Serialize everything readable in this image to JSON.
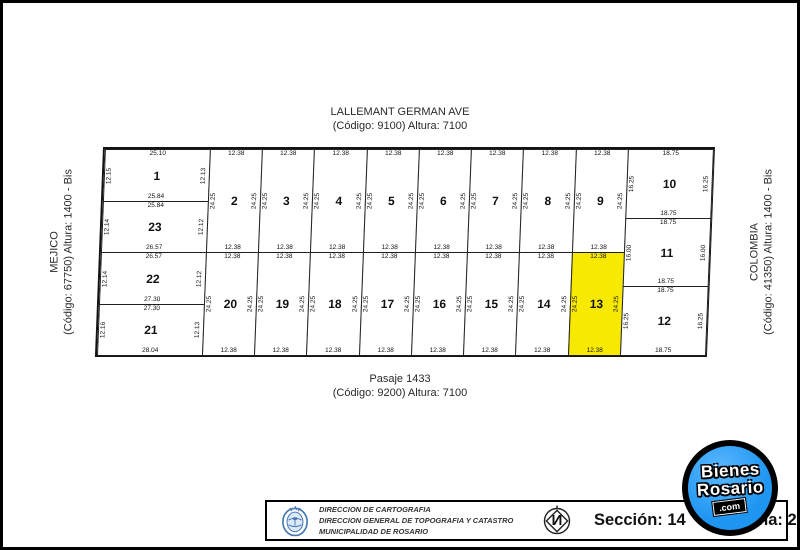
{
  "streets": {
    "top": {
      "name": "LALLEMANT GERMAN AVE",
      "detail": "(Código: 9100) Altura: 7100"
    },
    "bottom": {
      "name": "Pasaje 1433",
      "detail": "(Código: 9200) Altura: 7100"
    },
    "left": {
      "name": "MEJICO",
      "detail": "(Código: 67750) Altura: 1400 - Bis"
    },
    "right": {
      "name": "COLOMBIA",
      "detail": "(Código: 41350) Altura: 1400 - Bis"
    }
  },
  "plan": {
    "highlight_color": "#f7ea00",
    "line_color": "#1f1f1f",
    "highlighted_lot": "13",
    "lots": [
      {
        "n": "1",
        "x": 0,
        "y": 0,
        "w": 105,
        "h": 52,
        "top": "25.10",
        "bottom": "25.84",
        "left": "12.15",
        "right": "12.13",
        "hl": false
      },
      {
        "n": "23",
        "x": 0,
        "y": 52,
        "w": 105,
        "h": 51,
        "top": "25.84",
        "bottom": "26.57",
        "left": "12.14",
        "right": "12.12",
        "hl": false
      },
      {
        "n": "22",
        "x": 0,
        "y": 103,
        "w": 105,
        "h": 52,
        "top": "26.57",
        "bottom": "27.30",
        "left": "12.14",
        "right": "12.12",
        "hl": false
      },
      {
        "n": "21",
        "x": 0,
        "y": 155,
        "w": 105,
        "h": 51,
        "top": "27.30",
        "bottom": "28.04",
        "left": "12.16",
        "right": "12.13",
        "hl": false
      },
      {
        "n": "2",
        "x": 105,
        "y": 0,
        "w": 52,
        "h": 103,
        "top": "12.38",
        "bottom": "12.38",
        "left": "24.25",
        "right": "24.25",
        "hl": false
      },
      {
        "n": "3",
        "x": 157,
        "y": 0,
        "w": 52,
        "h": 103,
        "top": "12.38",
        "bottom": "12.38",
        "left": "24.25",
        "right": "24.25",
        "hl": false
      },
      {
        "n": "4",
        "x": 209,
        "y": 0,
        "w": 53,
        "h": 103,
        "top": "12.38",
        "bottom": "12.38",
        "left": "24.25",
        "right": "24.25",
        "hl": false
      },
      {
        "n": "5",
        "x": 262,
        "y": 0,
        "w": 52,
        "h": 103,
        "top": "12.38",
        "bottom": "12.38",
        "left": "24.25",
        "right": "24.25",
        "hl": false
      },
      {
        "n": "6",
        "x": 314,
        "y": 0,
        "w": 52,
        "h": 103,
        "top": "12.38",
        "bottom": "12.38",
        "left": "24.25",
        "right": "24.25",
        "hl": false
      },
      {
        "n": "7",
        "x": 366,
        "y": 0,
        "w": 52,
        "h": 103,
        "top": "12.38",
        "bottom": "12.38",
        "left": "24.25",
        "right": "24.25",
        "hl": false
      },
      {
        "n": "8",
        "x": 418,
        "y": 0,
        "w": 53,
        "h": 103,
        "top": "12.38",
        "bottom": "12.38",
        "left": "24.25",
        "right": "24.25",
        "hl": false
      },
      {
        "n": "9",
        "x": 471,
        "y": 0,
        "w": 52,
        "h": 103,
        "top": "12.38",
        "bottom": "12.38",
        "left": "24.25",
        "right": "24.25",
        "hl": false
      },
      {
        "n": "20",
        "x": 105,
        "y": 103,
        "w": 52,
        "h": 103,
        "top": "12.38",
        "bottom": "12.38",
        "left": "24.25",
        "right": "24.25",
        "hl": false
      },
      {
        "n": "19",
        "x": 157,
        "y": 103,
        "w": 52,
        "h": 103,
        "top": "12.38",
        "bottom": "12.38",
        "left": "24.25",
        "right": "24.25",
        "hl": false
      },
      {
        "n": "18",
        "x": 209,
        "y": 103,
        "w": 53,
        "h": 103,
        "top": "12.38",
        "bottom": "12.38",
        "left": "24.25",
        "right": "24.25",
        "hl": false
      },
      {
        "n": "17",
        "x": 262,
        "y": 103,
        "w": 52,
        "h": 103,
        "top": "12.38",
        "bottom": "12.38",
        "left": "24.25",
        "right": "24.25",
        "hl": false
      },
      {
        "n": "16",
        "x": 314,
        "y": 103,
        "w": 52,
        "h": 103,
        "top": "12.38",
        "bottom": "12.38",
        "left": "24.25",
        "right": "24.25",
        "hl": false
      },
      {
        "n": "15",
        "x": 366,
        "y": 103,
        "w": 52,
        "h": 103,
        "top": "12.38",
        "bottom": "12.38",
        "left": "24.25",
        "right": "24.25",
        "hl": false
      },
      {
        "n": "14",
        "x": 418,
        "y": 103,
        "w": 53,
        "h": 103,
        "top": "12.38",
        "bottom": "12.38",
        "left": "24.25",
        "right": "24.25",
        "hl": false
      },
      {
        "n": "13",
        "x": 471,
        "y": 103,
        "w": 52,
        "h": 103,
        "top": "12.38",
        "bottom": "12.38",
        "left": "24.25",
        "right": "24.25",
        "hl": true
      },
      {
        "n": "10",
        "x": 523,
        "y": 0,
        "w": 85,
        "h": 69,
        "top": "18.75",
        "bottom": "18.75",
        "left": "16.25",
        "right": "16.25",
        "hl": false
      },
      {
        "n": "11",
        "x": 523,
        "y": 69,
        "w": 85,
        "h": 68,
        "top": "18.75",
        "bottom": "18.75",
        "left": "16.00",
        "right": "16.00",
        "hl": false
      },
      {
        "n": "12",
        "x": 523,
        "y": 137,
        "w": 85,
        "h": 69,
        "top": "18.75",
        "bottom": "18.75",
        "left": "16.25",
        "right": "16.25",
        "hl": false
      }
    ]
  },
  "footer": {
    "lines": [
      "DIRECCION DE CARTOGRAFIA",
      "DIRECCION GENERAL DE TOPOGRAFIA Y CATASTRO",
      "MUNICIPALIDAD DE ROSARIO"
    ],
    "seccion": "Sección: 14",
    "manzana": "Manzana: 284",
    "north_letter": "N"
  },
  "logo": {
    "line1": "Bienes",
    "line2": "Rosario",
    "line3": ".com",
    "bg": "#1d95f1"
  }
}
